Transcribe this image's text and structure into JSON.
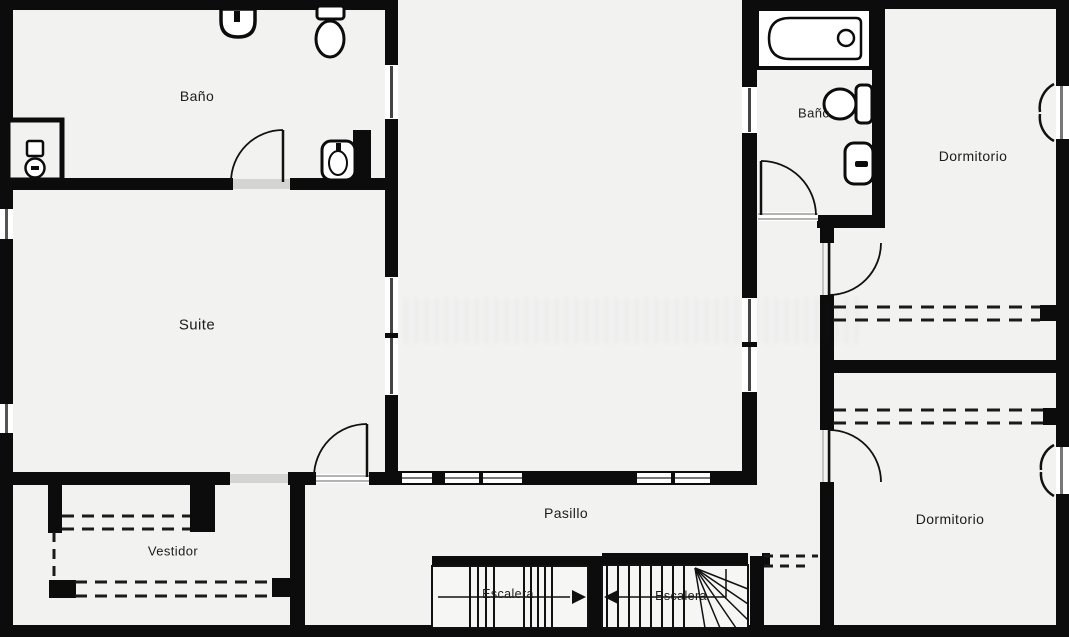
{
  "plan": {
    "type": "floor-plan",
    "language": "es",
    "colors": {
      "background": "#f2f2f1",
      "wall": "#0c0c0c",
      "line": "#111111",
      "threshold": "#d4d4d2",
      "window_line": "#9a9a9a",
      "fixture_fill": "#ffffff",
      "label_text": "#1c1c1c"
    }
  },
  "rooms": {
    "bano_left": {
      "label": "Baño"
    },
    "suite": {
      "label": "Suite"
    },
    "vestidor": {
      "label": "Vestidor"
    },
    "pasillo": {
      "label": "Pasillo"
    },
    "escalera_left": {
      "label": "Escalera"
    },
    "escalera_right": {
      "label": "Escalera"
    },
    "bano_right": {
      "label": "Baño"
    },
    "dormitorio_top": {
      "label": "Dormitorio"
    },
    "dormitorio_bottom": {
      "label": "Dormitorio"
    }
  },
  "icons": [
    "washbasin-icon",
    "toilet-icon",
    "shower-tray-icon",
    "small-basin-icon",
    "bathtub-icon",
    "door-swing-icon",
    "casement-window-icon",
    "stairs-up-arrow-icon",
    "stairs-down-arrow-icon",
    "wardrobe-dashed-icon"
  ]
}
